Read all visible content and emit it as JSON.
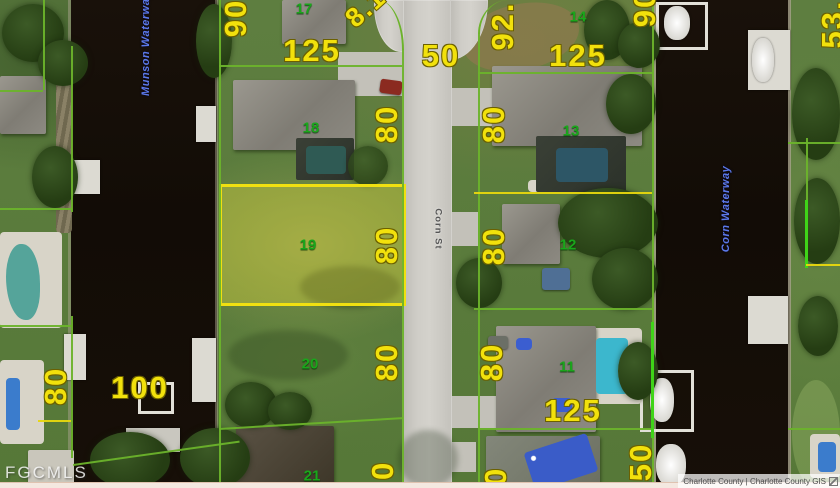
{
  "map": {
    "watermark": "FGCMLS",
    "attribution": "Charlotte County | Charlotte County GIS",
    "street": "Corn St",
    "waterway_left": "Munson Waterway",
    "waterway_right": "Corn Waterway",
    "selected_lot": "19",
    "parcel_dimensions": [
      "90",
      "125",
      "8.1",
      "50",
      "92.",
      "125",
      "90",
      "53.",
      "80",
      "80",
      "80",
      "80",
      "80",
      "100",
      "80",
      "80",
      "125",
      "80",
      "80",
      "50"
    ],
    "lot_numbers": [
      "17",
      "18",
      "19",
      "20",
      "21",
      "14",
      "13",
      "12",
      "11"
    ],
    "colors": {
      "dimension_text": "#f2e10c",
      "lot_text": "#1aa61b",
      "parcel_line_green": "#6cb32b",
      "parcel_line_yellow": "#e8d70e",
      "selected_parcel_border": "#f0e011",
      "waterway_text": "#5b79ea",
      "water": "#140d07",
      "road": "#cccac4"
    }
  }
}
